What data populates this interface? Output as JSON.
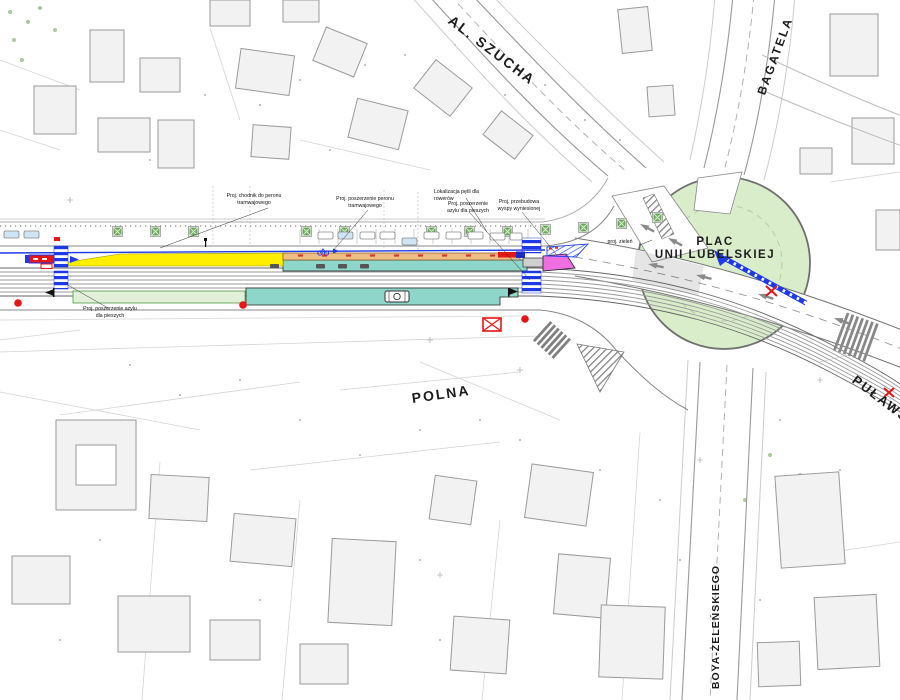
{
  "streets": {
    "al_szucha": "AL. SZUCHA",
    "bagatela": "BAGATELA",
    "plac_unii_line1": "PLAC",
    "plac_unii_line2": "UNII LUBELSKIEJ",
    "polna": "POLNA",
    "pulawska": "PUŁAWSKA",
    "boya_zelenskiego": "BOYA-ŻELEŃSKIEGO"
  },
  "annotations": [
    {
      "text": "Proj. chodnik do peronu tramwajowego"
    },
    {
      "text": "Proj. poszerzenie peronu tramwajowego"
    },
    {
      "text": "Lokalizacja pętli dla rowerów"
    },
    {
      "text": "Proj. poszerzenie azylu dla pieszych"
    },
    {
      "text": "Proj. przebudowa wyspy wyniesionej"
    },
    {
      "text": "proj. zieleń"
    },
    {
      "text": "Proj. poszerzenie azylu dla pieszych"
    }
  ],
  "colors": {
    "platform_proposed_yellow": "#ffee00",
    "platform_existing_orange": "#edbd84",
    "pavement_teal": "#8fd6ca",
    "green_plaza": "#d9edcb",
    "green_strip": "#e2f0da",
    "crossing_blue": "#1d39e8",
    "highlight_magenta": "#ef6fe3",
    "marker_red": "#e81515",
    "tree_green": "#7cb86a"
  }
}
